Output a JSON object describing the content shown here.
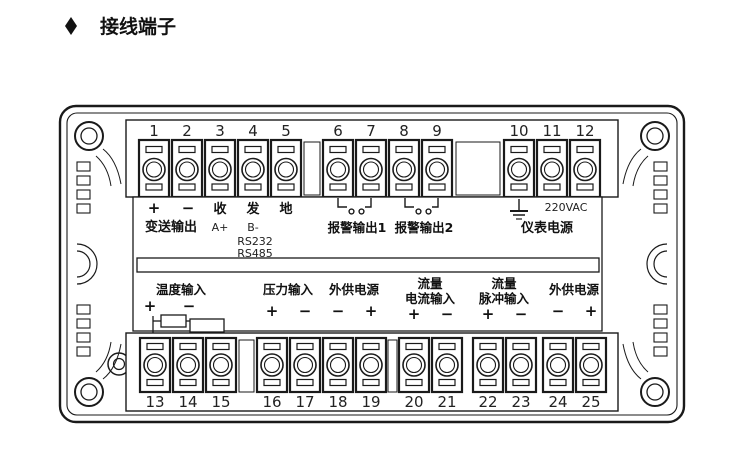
{
  "title": {
    "bullet_icon": "diamond",
    "text": "接线端子"
  },
  "terminals": {
    "top": [
      "1",
      "2",
      "3",
      "4",
      "5",
      "6",
      "7",
      "8",
      "9",
      "10",
      "11",
      "12"
    ],
    "bottom": [
      "13",
      "14",
      "15",
      "16",
      "17",
      "18",
      "19",
      "20",
      "21",
      "22",
      "23",
      "24",
      "25"
    ]
  },
  "labels": {
    "transmitter_plus": "+",
    "transmitter_minus": "−",
    "transmitter": "变送输出",
    "rx": "收",
    "tx": "发",
    "ground": "地",
    "rs485_a": "A+",
    "rs485_b": "B-",
    "rs232": "RS232",
    "rs485": "RS485",
    "alarm1": "报警输出1",
    "alarm2": "报警输出2",
    "ac_voltage": "220VAC",
    "meter_power": "仪表电源",
    "temp_input": "温度输入",
    "temp_plus": "+",
    "temp_minus": "−",
    "pressure_input": "压力输入",
    "pressure_plus": "+",
    "pressure_minus": "−",
    "ext_power_left": "外供电源",
    "ext_left_minus": "−",
    "ext_left_plus": "+",
    "flow_current_line1": "流量",
    "flow_current_line2": "电流输入",
    "flow_current_plus": "+",
    "flow_current_minus": "−",
    "flow_pulse_line1": "流量",
    "flow_pulse_line2": "脉冲输入",
    "flow_pulse_plus": "+",
    "flow_pulse_minus": "−",
    "ext_power_right": "外供电源",
    "ext_right_minus": "−",
    "ext_right_plus": "+"
  },
  "colors": {
    "line": "#1a1a1a",
    "background": "#ffffff"
  }
}
